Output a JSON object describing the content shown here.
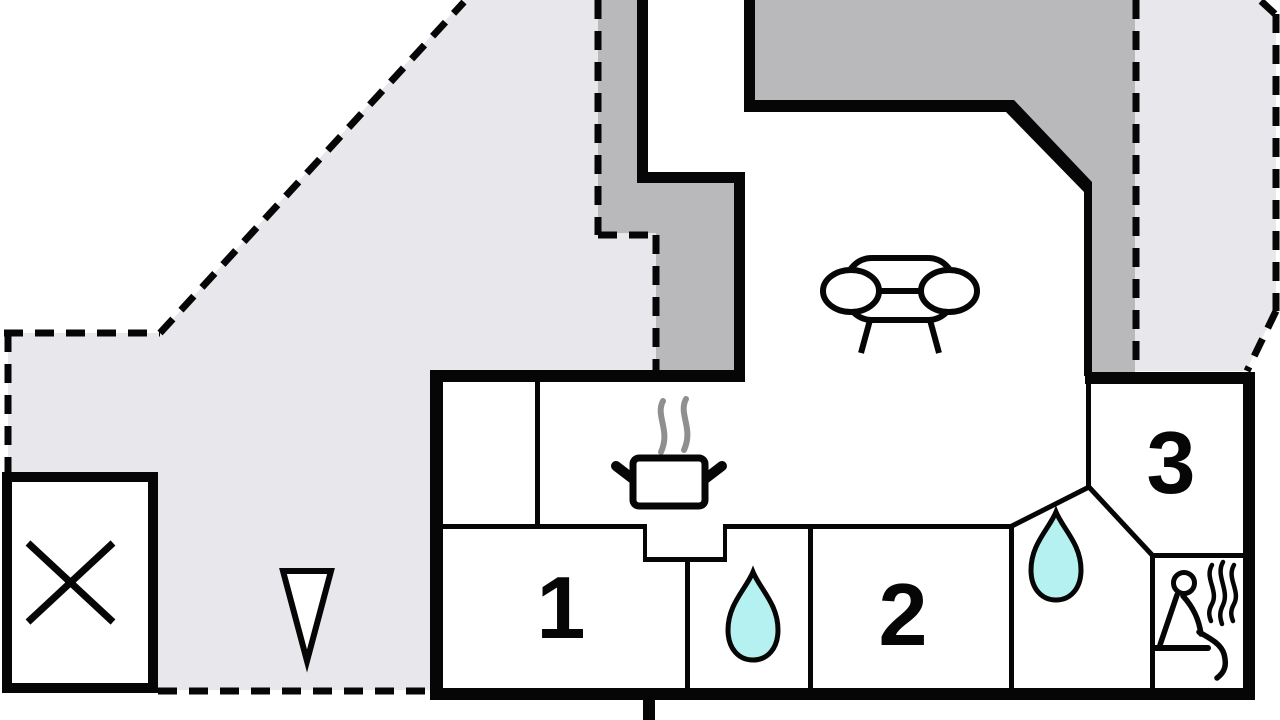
{
  "rooms": [
    {
      "label": "1"
    },
    {
      "label": "2"
    },
    {
      "label": "3"
    }
  ],
  "icons": {
    "sofa": "sofa-icon",
    "cooking_pot": "cooking-pot-icon",
    "kitchen_steam": "steam-icon",
    "bathroom_drop_small": "water-drop-icon",
    "bathroom_drop_large": "water-drop-icon",
    "sauna_person": "sauna-person-icon",
    "sauna_steam": "steam-icon",
    "crossed_box": "crossed-box-icon",
    "north_arrow": "north-arrow-icon"
  },
  "colors": {
    "background": "#ffffff",
    "terrace": "#e8e8ec",
    "roof_overhang": "#b9b9bb",
    "wall": "#060606",
    "water": "#b5f1f0",
    "steam": "#8f8f8f"
  }
}
